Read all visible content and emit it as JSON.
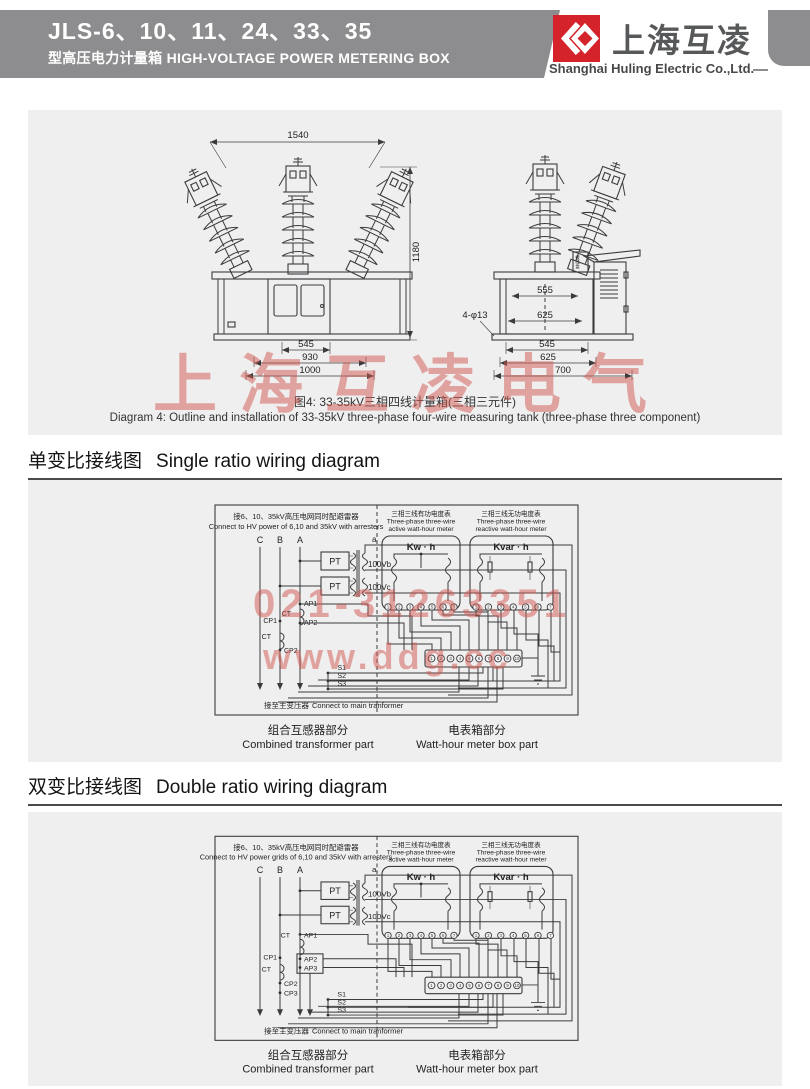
{
  "header": {
    "model": "JLS-6、10、11、24、33、35",
    "subtitle_cn": "型高压电力计量箱",
    "subtitle_en": "HIGH-VOLTAGE POWER METERING BOX",
    "brand_cn": "上海互凌",
    "brand_en": "Shanghai Huling Electric Co.,Ltd.",
    "banner_color": "#8d8d8f",
    "logo_color": "#d4232a"
  },
  "watermarks": {
    "brand": "上海互凌电气",
    "phone": "021-31263351",
    "site": "www.ddg.cc",
    "color": "#d2574f"
  },
  "outline": {
    "front": {
      "dim_top": "1540",
      "dim_right": "1180",
      "dim_b1": "545",
      "dim_b2": "930",
      "dim_b3": "1000"
    },
    "side": {
      "dim_in1": "555",
      "dim_in2": "625",
      "holes": "4-φ13",
      "junction_box": "接线盒",
      "dim_b1": "545",
      "dim_b2": "625",
      "dim_b3": "700"
    },
    "caption_cn": "图4: 33-35kV三相四线计量箱(三相三元件)",
    "caption_en": "Diagram 4: Outline and installation of 33-35kV three-phase four-wire measuring tank (three-phase three component)"
  },
  "sections": [
    {
      "title_cn": "单变比接线图",
      "title_en": "Single ratio wiring diagram"
    },
    {
      "title_cn": "双变比接线图",
      "title_en": "Double ratio wiring diagram"
    }
  ],
  "diagram1": {
    "hv_cn": "接6、10、35kV高压电网同时配避雷器",
    "hv_en": "Connect to HV power of 6,10 and 35kV with arresters",
    "phase_c": "C",
    "phase_b": "B",
    "phase_a": "A",
    "pt": "PT",
    "out_a": "a",
    "out_b": "100Vb",
    "out_c": "100Vc",
    "ct": "CT",
    "ap1": "AP1",
    "ap2": "AP2",
    "cp1": "CP1",
    "cp2": "CP2",
    "s1": "S1",
    "s2": "S2",
    "s3": "S3",
    "to_main_cn": "接至主变压器",
    "to_main_en": "Connect to main tranformer",
    "active_cn": "三相三线有功电度表",
    "active_en1": "Three-phase three-wire",
    "active_en2": "active watt-hour meter",
    "reactive_cn": "三相三线无功电度表",
    "reactive_en1": "Three-phase three-wire",
    "reactive_en2": "reactive watt-hour meter",
    "kwh": "Kw · h",
    "kvarh": "Kvar · h",
    "m1_terminals": [
      "1",
      "2",
      "3",
      "4",
      "5",
      "6",
      "7"
    ],
    "m2_terminals": [
      "1",
      "2",
      "3",
      "4",
      "5",
      "6",
      "7"
    ],
    "strip_terminals": [
      "1",
      "2",
      "3",
      "4",
      "5",
      "6",
      "7",
      "8",
      "9",
      "10"
    ],
    "part_left_cn": "组合互感器部分",
    "part_left_en": "Combined transformer part",
    "part_right_cn": "电表箱部分",
    "part_right_en": "Watt-hour meter box part"
  },
  "diagram2": {
    "hv_cn": "接6、10、35kV高压电网同时配避雷器",
    "hv_en": "Connect to HV power grids of 6,10 and 35kV with arresters",
    "phase_c": "C",
    "phase_b": "B",
    "phase_a": "A",
    "pt": "PT",
    "out_a": "a",
    "out_b": "100Vb",
    "out_c": "100Vc",
    "ct": "CT",
    "ap1": "AP1",
    "ap2": "AP2",
    "ap3": "AP3",
    "cp1": "CP1",
    "cp2": "CP2",
    "cp3": "CP3",
    "s1": "S1",
    "s2": "S2",
    "s3": "S3",
    "to_main_cn": "接至主变压器",
    "to_main_en": "Connect to main tranformer",
    "active_cn": "三相三线有功电度表",
    "active_en1": "Three-phase three-wire",
    "active_en2": "active watt-hour meter",
    "reactive_cn": "三相三线无功电度表",
    "reactive_en1": "Three-phase three-wire",
    "reactive_en2": "reactive watt-hour meter",
    "kwh": "Kw · h",
    "kvarh": "Kvar · h",
    "m1_terminals": [
      "1",
      "2",
      "3",
      "4",
      "5",
      "6",
      "7"
    ],
    "m2_terminals": [
      "1",
      "2",
      "3",
      "4",
      "5",
      "6",
      "7"
    ],
    "strip_terminals": [
      "1",
      "2",
      "3",
      "4",
      "5",
      "6",
      "7",
      "8",
      "9",
      "10"
    ],
    "part_left_cn": "组合互感器部分",
    "part_left_en": "Combined transformer part",
    "part_right_cn": "电表箱部分",
    "part_right_en": "Watt-hour meter box part"
  }
}
